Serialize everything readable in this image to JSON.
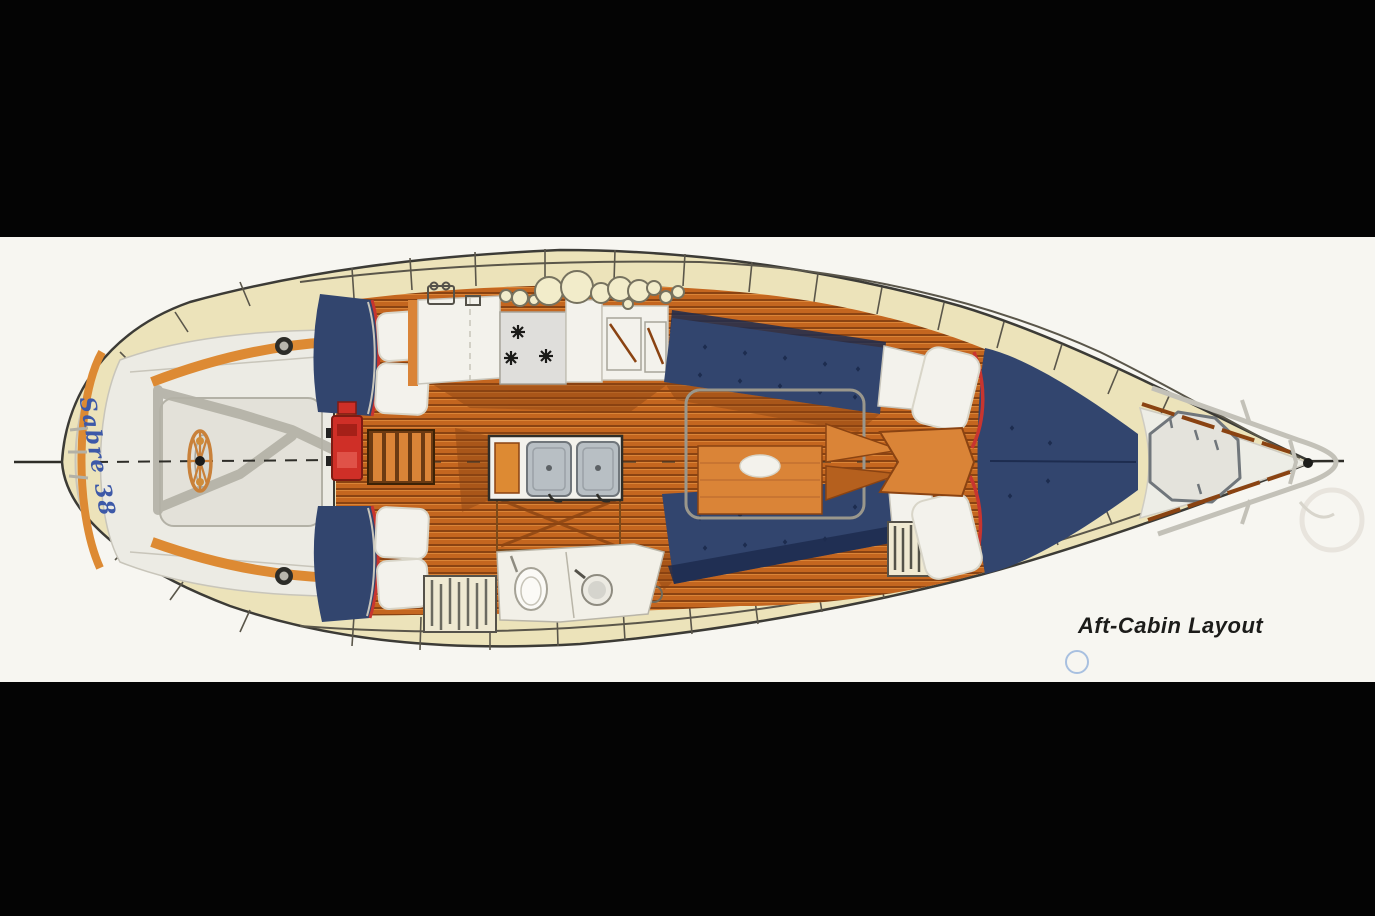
{
  "photo": {
    "caption": "Aft-Cabin Layout",
    "boat_name": "Sabre 38"
  },
  "colors": {
    "photo_black": "#040404",
    "page_white": "#f7f6f1",
    "deck_cream": "#ece3ba",
    "plate_cream": "#f2ecca",
    "hull_line": "#3c3b36",
    "rail_line": "#5a564a",
    "line_dark": "#2e2d28",
    "teak": "#c4661f",
    "teak_light": "#da8437",
    "teak_dark": "#8a4312",
    "navy": "#32456e",
    "navy_dark": "#1d2c4f",
    "cushion_white": "#f3f2ec",
    "cushion_edge": "#d8d5c8",
    "gray_deck": "#b3b1a6",
    "soft_gray": "#c8c5ba",
    "cockpit_floor": "#ecebe4",
    "cockpit_well": "#e3e1d9",
    "orange_trim": "#dd8a33",
    "engine_red": "#cf2f27",
    "steel": "#b8bfc4",
    "steel_dark": "#70767b",
    "red_trim": "#c8352f",
    "name_blue": "#3d59a8",
    "caption_dark": "#1c1c1a",
    "faint_blue": "#a8c0e0",
    "ghost_gray": "#e3e0d8"
  }
}
